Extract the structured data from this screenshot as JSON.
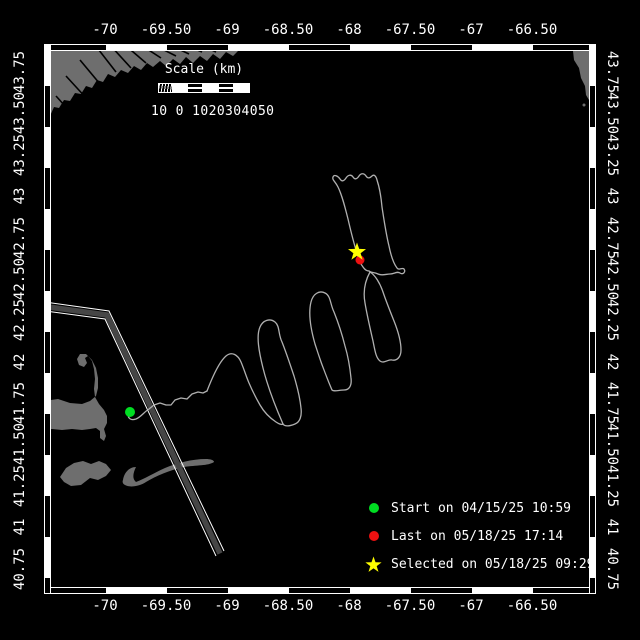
{
  "axes": {
    "x_labels": [
      {
        "t": "-70",
        "x": 105
      },
      {
        "t": "-69.50",
        "x": 166
      },
      {
        "t": "-69",
        "x": 227
      },
      {
        "t": "-68.50",
        "x": 288
      },
      {
        "t": "-68",
        "x": 349
      },
      {
        "t": "-67.50",
        "x": 410
      },
      {
        "t": "-67",
        "x": 471
      },
      {
        "t": "-66.50",
        "x": 532
      }
    ],
    "y_labels": [
      {
        "t": "43.75",
        "y": 73
      },
      {
        "t": "43.50",
        "y": 114
      },
      {
        "t": "43.25",
        "y": 156
      },
      {
        "t": "43",
        "y": 197
      },
      {
        "t": "42.75",
        "y": 239
      },
      {
        "t": "42.50",
        "y": 280
      },
      {
        "t": "42.25",
        "y": 321
      },
      {
        "t": "42",
        "y": 363
      },
      {
        "t": "41.75",
        "y": 404
      },
      {
        "t": "41.50",
        "y": 445
      },
      {
        "t": "41.25",
        "y": 487
      },
      {
        "t": "41",
        "y": 528
      },
      {
        "t": "40.75",
        "y": 570
      }
    ]
  },
  "scale_bar": {
    "title": "Scale (km)",
    "numbers": "10 0 1020304050"
  },
  "legend": {
    "items": [
      {
        "marker": "circle",
        "color": "#00dd22",
        "label": "Start on 04/15/25 10:59"
      },
      {
        "marker": "circle",
        "color": "#ee1111",
        "label": "Last on 05/18/25 17:14"
      },
      {
        "marker": "star",
        "color": "#ffff00",
        "label": "Selected on 05/18/25 09:29"
      }
    ]
  },
  "map": {
    "land_color": "#6e6e6e",
    "track_color": "#b0b0b0",
    "lane_fill_color": "#464646",
    "land_paths": [
      "M44,44 L240,44 L239,50 L233,56 L226,52 L220,59 L213,54 L207,61 L200,56 L193,63 L186,57 L180,64 L173,59 L166,66 L160,61 L153,67 L147,63 L141,70 L134,66 L128,73 L121,70 L115,77 L108,74 L103,82 L97,80 L92,88 L86,86 L81,94 L75,93 L70,101 L64,100 L59,108 L54,107 L50,116 L46,115 L44,122 Z",
      "M570,44 L589,44 L589,100 L586,95 L585,86 L581,78 L579,68 L574,60 L573,51 L570,47 Z",
      "M44,401 L58,399 L70,403 L82,404 L90,401 L96,396 L98,388 L98,378 L96,368 L92,360 L86,354 L80,354 L77,359 L79,365 L84,367 L87,363 L85,358 L88,356 L92,361 L94,369 L95,379 L94,389 L95,397 L99,404 L104,410 L107,416 L107,423 L104,429 L106,436 L104,441 L100,438 L100,431 L96,428 L90,429 L82,430 L72,429 L62,430 L52,429 L44,430 Z",
      "M60,477 L66,468 L74,463 L83,461 L91,464 L99,461 L106,464 L111,470 L106,476 L98,480 L90,478 L81,485 L71,486 L64,482 Z",
      "M123,480 C124,473 129,467 136,467 C133,473 132,479 136,482 C144,479 154,473 165,468 C177,463 192,459 206,459 C210,459 214,460 214,462 C208,466 196,465 184,467 C170,470 156,476 146,482 C140,486 130,488 125,485 C123,484 122,482 123,480 Z"
    ],
    "river_lines": [
      "M95,45 L116,72",
      "M110,45 L131,68",
      "M125,45 L146,63",
      "M141,45 L161,58",
      "M156,46 L176,56",
      "M172,46 L189,54",
      "M188,46 L202,52",
      "M203,46 L216,52",
      "M80,60 L100,84",
      "M66,76 L88,100",
      "M56,96 L74,116",
      "M48,112 L60,126"
    ],
    "lane": {
      "outer1": "M45,302 L109,311 L224,551",
      "outer2": "M45,311 L105,319 L216,556",
      "center": "M45,306.5 L107,315 L220,553.5"
    },
    "track_paths": [
      "M130,412 C126,417 130,421 136,419 C141,417 144,412 149,409 L154,405 L160,403 L166,405 L171,405 L175,400 L181,398 L187,399 L192,394 L198,392 L203,393 L207,391",
      "M207,391 C212,378 219,362 226,356 C232,351 238,355 241,362 C244,369 246,376 249,383 C252,390 256,398 260,405 C264,412 270,418 276,422 C279,424 282,425 283,424",
      "M283,424 C276,408 268,388 263,368 C259,352 256,336 260,327 C263,320 270,318 275,322 C280,326 278,334 282,342 C286,352 290,364 294,376 C297,386 300,398 301,408 C302,416 300,422 295,424 C290,426 285,427 283,424 Z",
      "M332,390 C326,376 320,360 315,344 C311,330 308,314 311,302 C313,294 319,290 325,293 C331,296 330,304 334,312 C338,322 342,334 345,346 C348,356 350,368 351,378 C352,386 349,390 344,390 C339,390 334,392 332,390 Z",
      "M370,272 C365,281 363,292 365,303 C367,315 370,328 373,341 C375,351 376,358 380,361 C384,364 388,359 392,360 C397,361 401,357 401,350 C401,341 398,331 394,321 C390,311 386,301 383,292 C380,283 375,275 370,272 Z",
      "M357,253 C354,244 351,232 348,219 C345,207 342,195 338,187 C335,181 332,180 333,177 C334,174 338,176 340,179 C342,182 344,181 346,178 C348,175 351,174 353,177 C355,180 357,179 359,176 C361,173 364,173 366,176 C368,179 370,178 372,176 C374,174 376,176 377,180 C379,186 381,196 382,207 C384,220 386,234 389,246 C391,256 394,264 397,268 C399,271 402,267 404,269 C406,272 403,275 400,273 C397,271 394,274 390,274 C386,274 382,276 378,274 C374,272 371,273 369,271",
      "M357,253 C358,258 360,263 363,267 C365,270 367,271 369,271"
    ],
    "markers": {
      "start": {
        "x": 130,
        "y": 412,
        "r": 5,
        "color": "#00dd22"
      },
      "last": {
        "x": 360,
        "y": 260,
        "r": 4.5,
        "color": "#ee1111"
      },
      "selected": {
        "x": 357,
        "y": 252,
        "R": 9.5,
        "r2": 3.8,
        "color": "#ffff00"
      },
      "ns_islet": {
        "x": 584,
        "y": 105,
        "r": 1.5
      }
    }
  }
}
